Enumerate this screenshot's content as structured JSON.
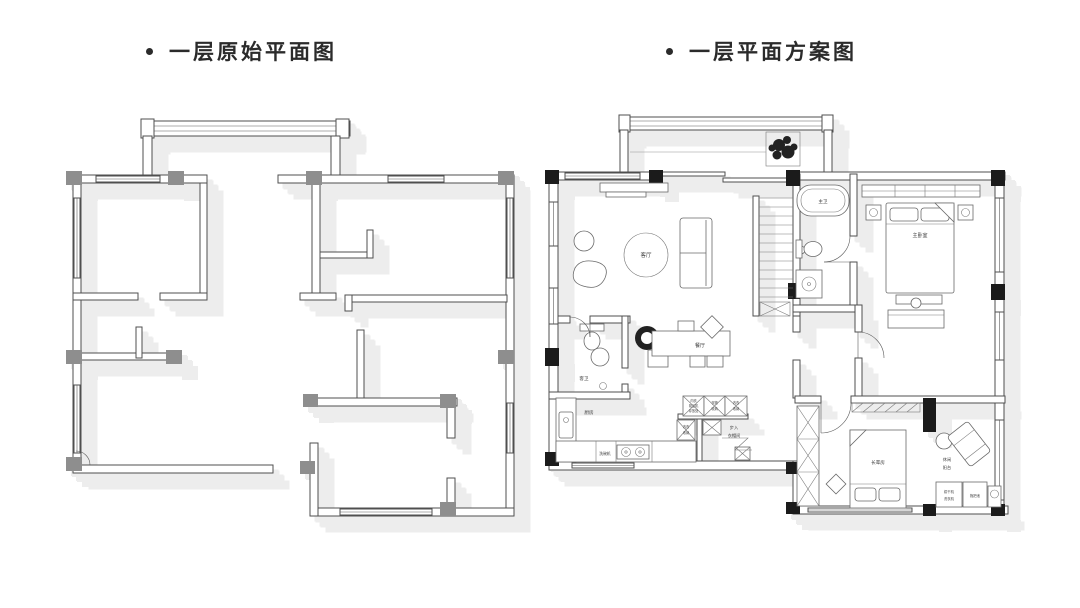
{
  "titles": {
    "left": "一层原始平面图",
    "right": "一层平面方案图"
  },
  "plan": {
    "living_room": "客厅",
    "dining_room": "餐厅",
    "guest_bath": "客卫",
    "kitchen": "厨房",
    "dishwasher": "洗碗机",
    "master_bath": "主卫",
    "master_bedroom": "主卧室",
    "elder_room": "长辈房",
    "walkin_closet_1": "步入",
    "walkin_closet_2": "衣帽间",
    "balcony_1": "休闲",
    "balcony_2": "阳台",
    "dryer": "烘干机",
    "washer": "洗衣机",
    "mop_pool": "拖把池",
    "cab1_1": "内衣",
    "cab1_2": "吸尘机",
    "cab1_3": "存放处",
    "cab2_1": "衣物",
    "cab2_2": "收纳",
    "cab3_1": "内衣",
    "cab3_2": "收纳",
    "cab4_1": "内衣",
    "cab4_2": "收纳"
  },
  "colors": {
    "wall": "#4f4f4f",
    "column_original": "#8e8e8e",
    "column_scheme": "#1b1b1b",
    "shadow": "#ededed",
    "background": "#ffffff"
  }
}
